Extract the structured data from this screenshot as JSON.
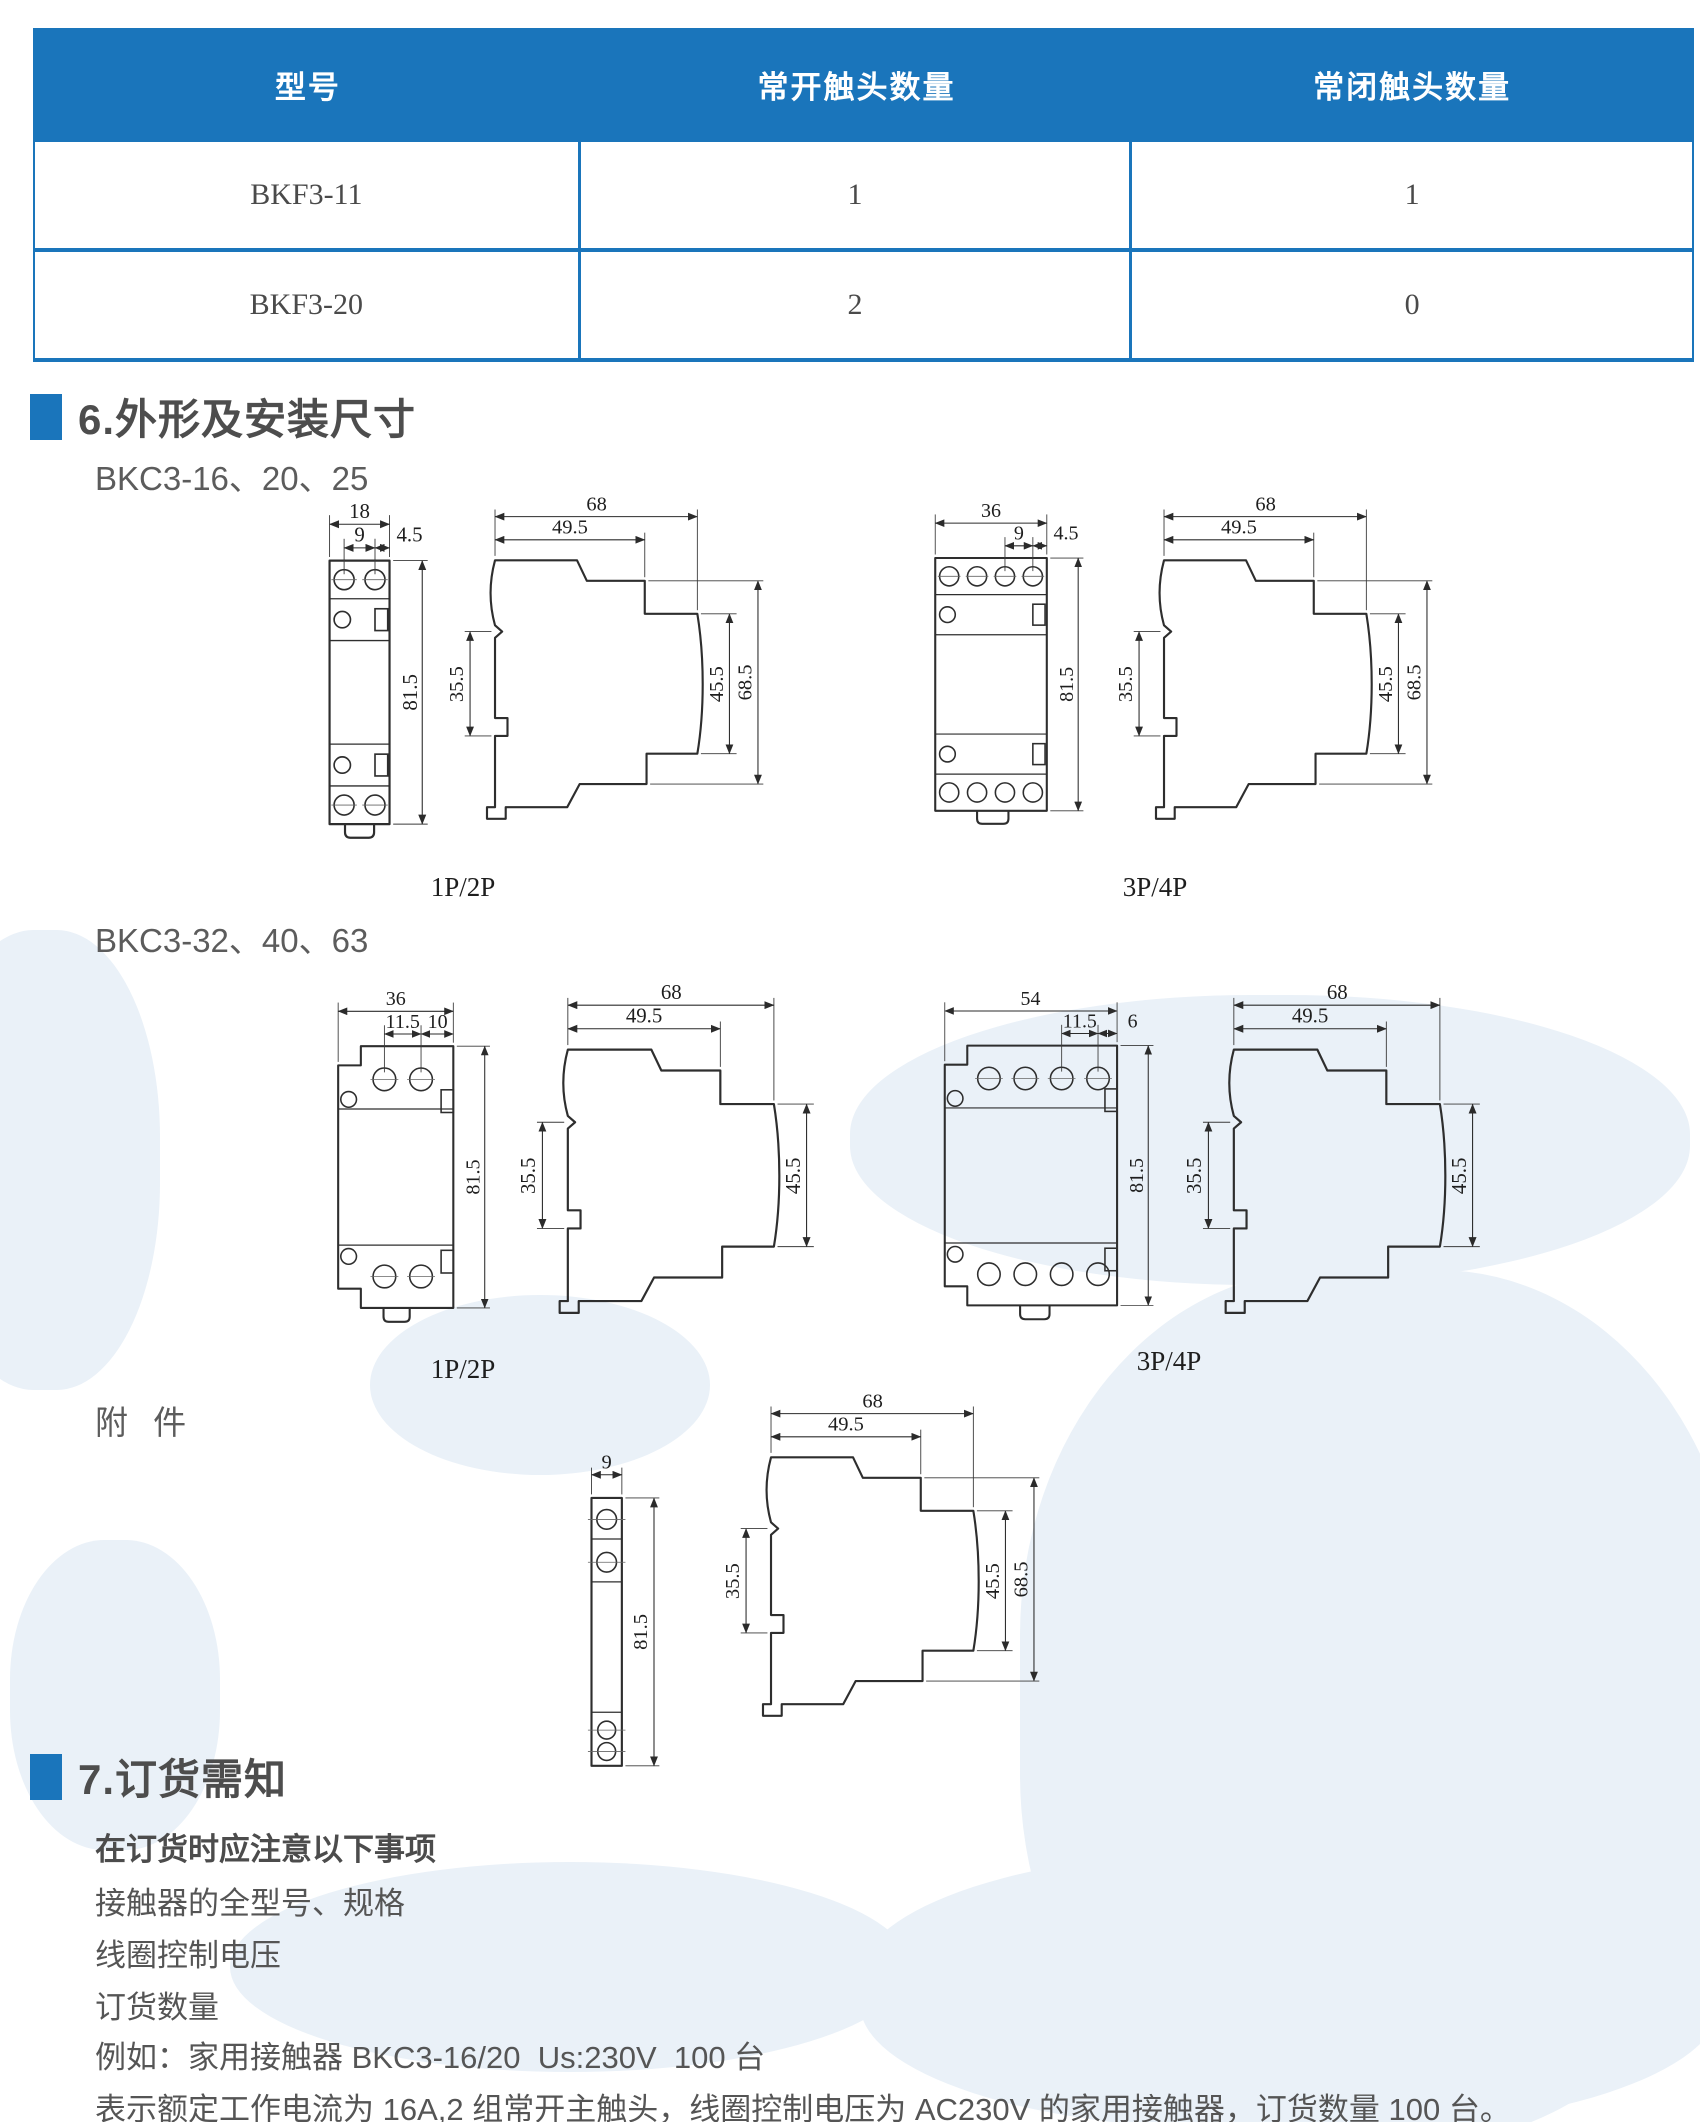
{
  "page": {
    "accent": "#1a75bb",
    "watermark": "#eaf1f8"
  },
  "table": {
    "headers": [
      "型号",
      "常开触头数量",
      "常闭触头数量"
    ],
    "rows": [
      [
        "BKF3-11",
        "1",
        "1"
      ],
      [
        "BKF3-20",
        "2",
        "0"
      ]
    ]
  },
  "section6": {
    "title": "6.外形及安装尺寸",
    "group1_label": "BKC3-16、20、25",
    "group2_label": "BKC3-32、40、63",
    "accessory_label": "附 件"
  },
  "drawings": {
    "g1a": {
      "label": "1P/2P",
      "front": {
        "w": "18",
        "pitch": "9",
        "edge": "4.5",
        "h": "81.5"
      },
      "side": {
        "w": "68",
        "w2": "49.5",
        "rail": "35.5",
        "face": "45.5",
        "h": "68.5"
      }
    },
    "g1b": {
      "label": "3P/4P",
      "front": {
        "w": "36",
        "pitch": "9",
        "edge": "4.5",
        "h": "81.5"
      },
      "side": {
        "w": "68",
        "w2": "49.5",
        "rail": "35.5",
        "face": "45.5",
        "h": "68.5"
      }
    },
    "g2a": {
      "label": "1P/2P",
      "front": {
        "w": "36",
        "pitch": "11.5",
        "edge": "10",
        "h": "81.5"
      },
      "side": {
        "w": "68",
        "w2": "49.5",
        "rail": "35.5",
        "face": "45.5"
      }
    },
    "g2b": {
      "label": "3P/4P",
      "front": {
        "w": "54",
        "pitch": "11.5",
        "edge": "6",
        "h": "81.5"
      },
      "side": {
        "w": "68",
        "w2": "49.5",
        "rail": "35.5",
        "face": "45.5"
      }
    },
    "acc": {
      "front": {
        "w": "9",
        "h": "81.5"
      },
      "side": {
        "w": "68",
        "w2": "49.5",
        "rail": "35.5",
        "face": "45.5",
        "h": "68.5"
      }
    }
  },
  "section7": {
    "title": "7.订货需知",
    "intro": "在订货时应注意以下事项",
    "items": [
      "接触器的全型号、规格",
      "线圈控制电压",
      "订货数量"
    ],
    "example": "例如：家用接触器 BKC3-16/20  Us:230V  100 台",
    "note": "表示额定工作电流为 16A,2 组常开主触头，线圈控制电压为 AC230V 的家用接触器，订货数量 100 台。"
  }
}
